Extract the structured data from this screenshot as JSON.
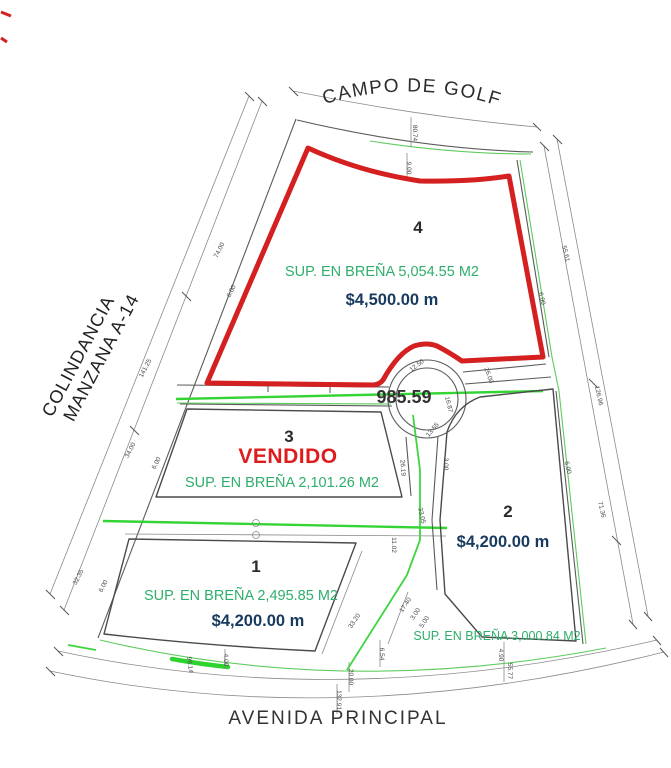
{
  "titles": {
    "golf": "CAMPO DE GOLF",
    "colindancia_line1": "COLINDANCIA",
    "colindancia_line2": "MANZANA A-14",
    "avenida": "AVENIDA PRINCIPAL"
  },
  "roundabout_label": "985.59",
  "lots": {
    "lot4": {
      "number": "4",
      "area": "SUP. EN BREÑA 5,054.55 M2",
      "price": "$4,500.00 m"
    },
    "lot3": {
      "number": "3",
      "status": "VENDIDO",
      "area": "SUP. EN BREÑA 2,101.26 M2"
    },
    "lot2": {
      "number": "2",
      "price": "$4,200.00 m",
      "area": "SUP. EN BREÑA 3,000.84 M2"
    },
    "lot1": {
      "number": "1",
      "area": "SUP. EN BREÑA 2,495.85 M2",
      "price": "$4,200.00 m"
    }
  },
  "dims": [
    "80.74",
    "9.00",
    "74.00",
    "6.00",
    "141.25",
    "34.00",
    "6.00",
    "32.35",
    "6.00",
    "99.14",
    "4.00",
    "55.61",
    "6.00",
    "126.96",
    "6.00",
    "71.36",
    "26.19",
    "33.05",
    "11.02",
    "3.00",
    "33.20",
    "17.40",
    "3.00",
    "5.00",
    "6.54",
    "20.00",
    "132.91",
    "4.90",
    "55.77",
    "12.50",
    "16.87",
    "13.55",
    "26.00"
  ],
  "colors": {
    "lot4_outline": "#d42020",
    "area_text": "#2fae6b",
    "price_text": "#183a5e",
    "sold_text": "#dd1d1d",
    "highlight_green": "#35d435",
    "survey_line": "#5a5a5a"
  }
}
